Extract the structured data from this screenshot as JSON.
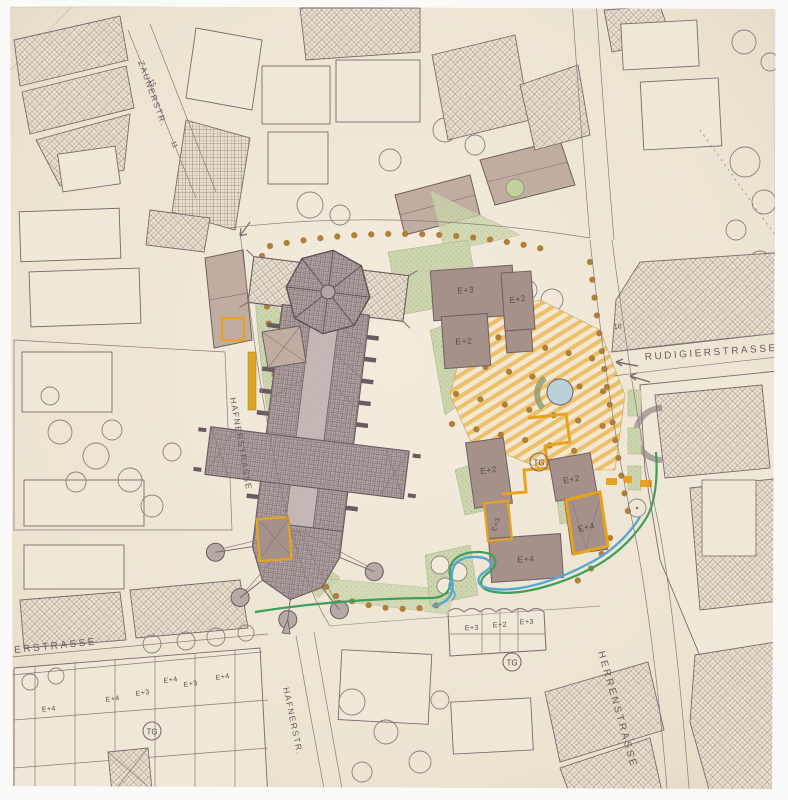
{
  "map_sheet": {
    "description": "Hand-drawn urban site plan of a cathedral quarter with planned interventions",
    "streets": [
      {
        "name": "rudigierstrasse",
        "label": "RUDIGIERSTRASSE"
      },
      {
        "name": "herrenstrasse",
        "label": "HERRENSTRASSE"
      },
      {
        "name": "hafnerstrasse",
        "label": "HAFNERSTRASSE"
      },
      {
        "name": "hafnerstrasse-south",
        "label": "HAFNERSTR."
      },
      {
        "name": "zaunerstrasse",
        "label": "ZAUNERSTR."
      },
      {
        "name": "terstrasse",
        "label": "TERSTRASSE"
      }
    ],
    "buildings": [
      {
        "label": "E+3"
      },
      {
        "label": "E+2"
      },
      {
        "label": "E+2"
      },
      {
        "label": "E+2"
      },
      {
        "label": "E+2"
      },
      {
        "label": "E+3"
      },
      {
        "label": "E+4"
      },
      {
        "label": "E+4"
      },
      {
        "label": "E+3"
      },
      {
        "label": "E+2"
      },
      {
        "label": "E+3"
      },
      {
        "label": "E+4"
      },
      {
        "label": "E+4"
      },
      {
        "label": "E+3"
      },
      {
        "label": "E+4"
      },
      {
        "label": "E+3"
      },
      {
        "label": "E+4"
      }
    ],
    "garage_labels": [
      {
        "label": "TG"
      },
      {
        "label": "TG"
      },
      {
        "label": "TG"
      }
    ],
    "house_numbers": [
      {
        "label": "15"
      },
      {
        "label": "11"
      },
      {
        "label": "10"
      }
    ],
    "legend_colors": {
      "paper": "#ece3d1",
      "ink": "#75646a",
      "new_building_fill": "#a5918a",
      "intervention_orange": "#e7a31f",
      "plaza_stripe": "#eec06a",
      "lawn_green": "#ccd5ad",
      "tree_dot": "#b08038",
      "stream_blue": "#56a7cf",
      "stream_green": "#3f9e57"
    }
  }
}
